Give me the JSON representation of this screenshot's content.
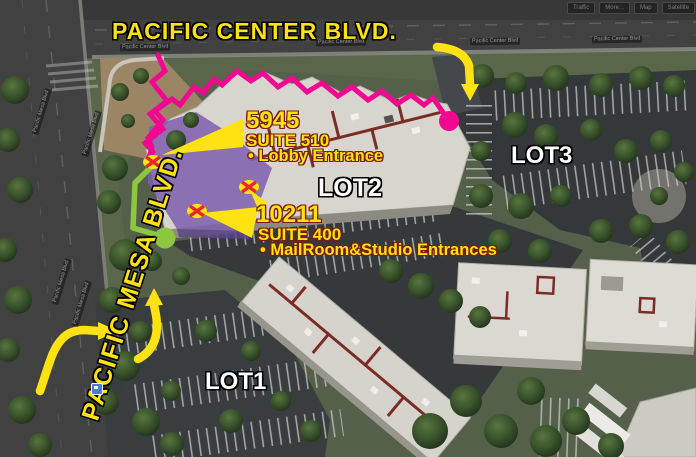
{
  "streets": {
    "pacific_center_blvd": "PACIFIC CENTER BLVD.",
    "pacific_mesa_blvd": "PACIFIC MESA BLVD.",
    "road_label_center": "Pacific Center Blvd",
    "road_label_mesa": "Pacific Mesa Blvd"
  },
  "map_toolbar": {
    "buttons": [
      "Traffic",
      "More...",
      "Map",
      "Satellite"
    ]
  },
  "lots": {
    "lot1": "LOT1",
    "lot2": "LOT2",
    "lot3": "LOT3"
  },
  "callouts": {
    "suite510": {
      "address": "5945",
      "suite": "SUITE 510",
      "note": "• Lobby Entrance"
    },
    "suite400": {
      "address": "10211",
      "suite": "SUITE 400",
      "note": "• MailRoom&Studio Entrances"
    }
  },
  "legend_colors": {
    "accent_yellow": "#ffe212",
    "route_magenta": "#f20791",
    "path_green": "#8dc63f",
    "building_highlight_purple": "#7e5fae",
    "entrance_x_red": "#e8262d"
  }
}
